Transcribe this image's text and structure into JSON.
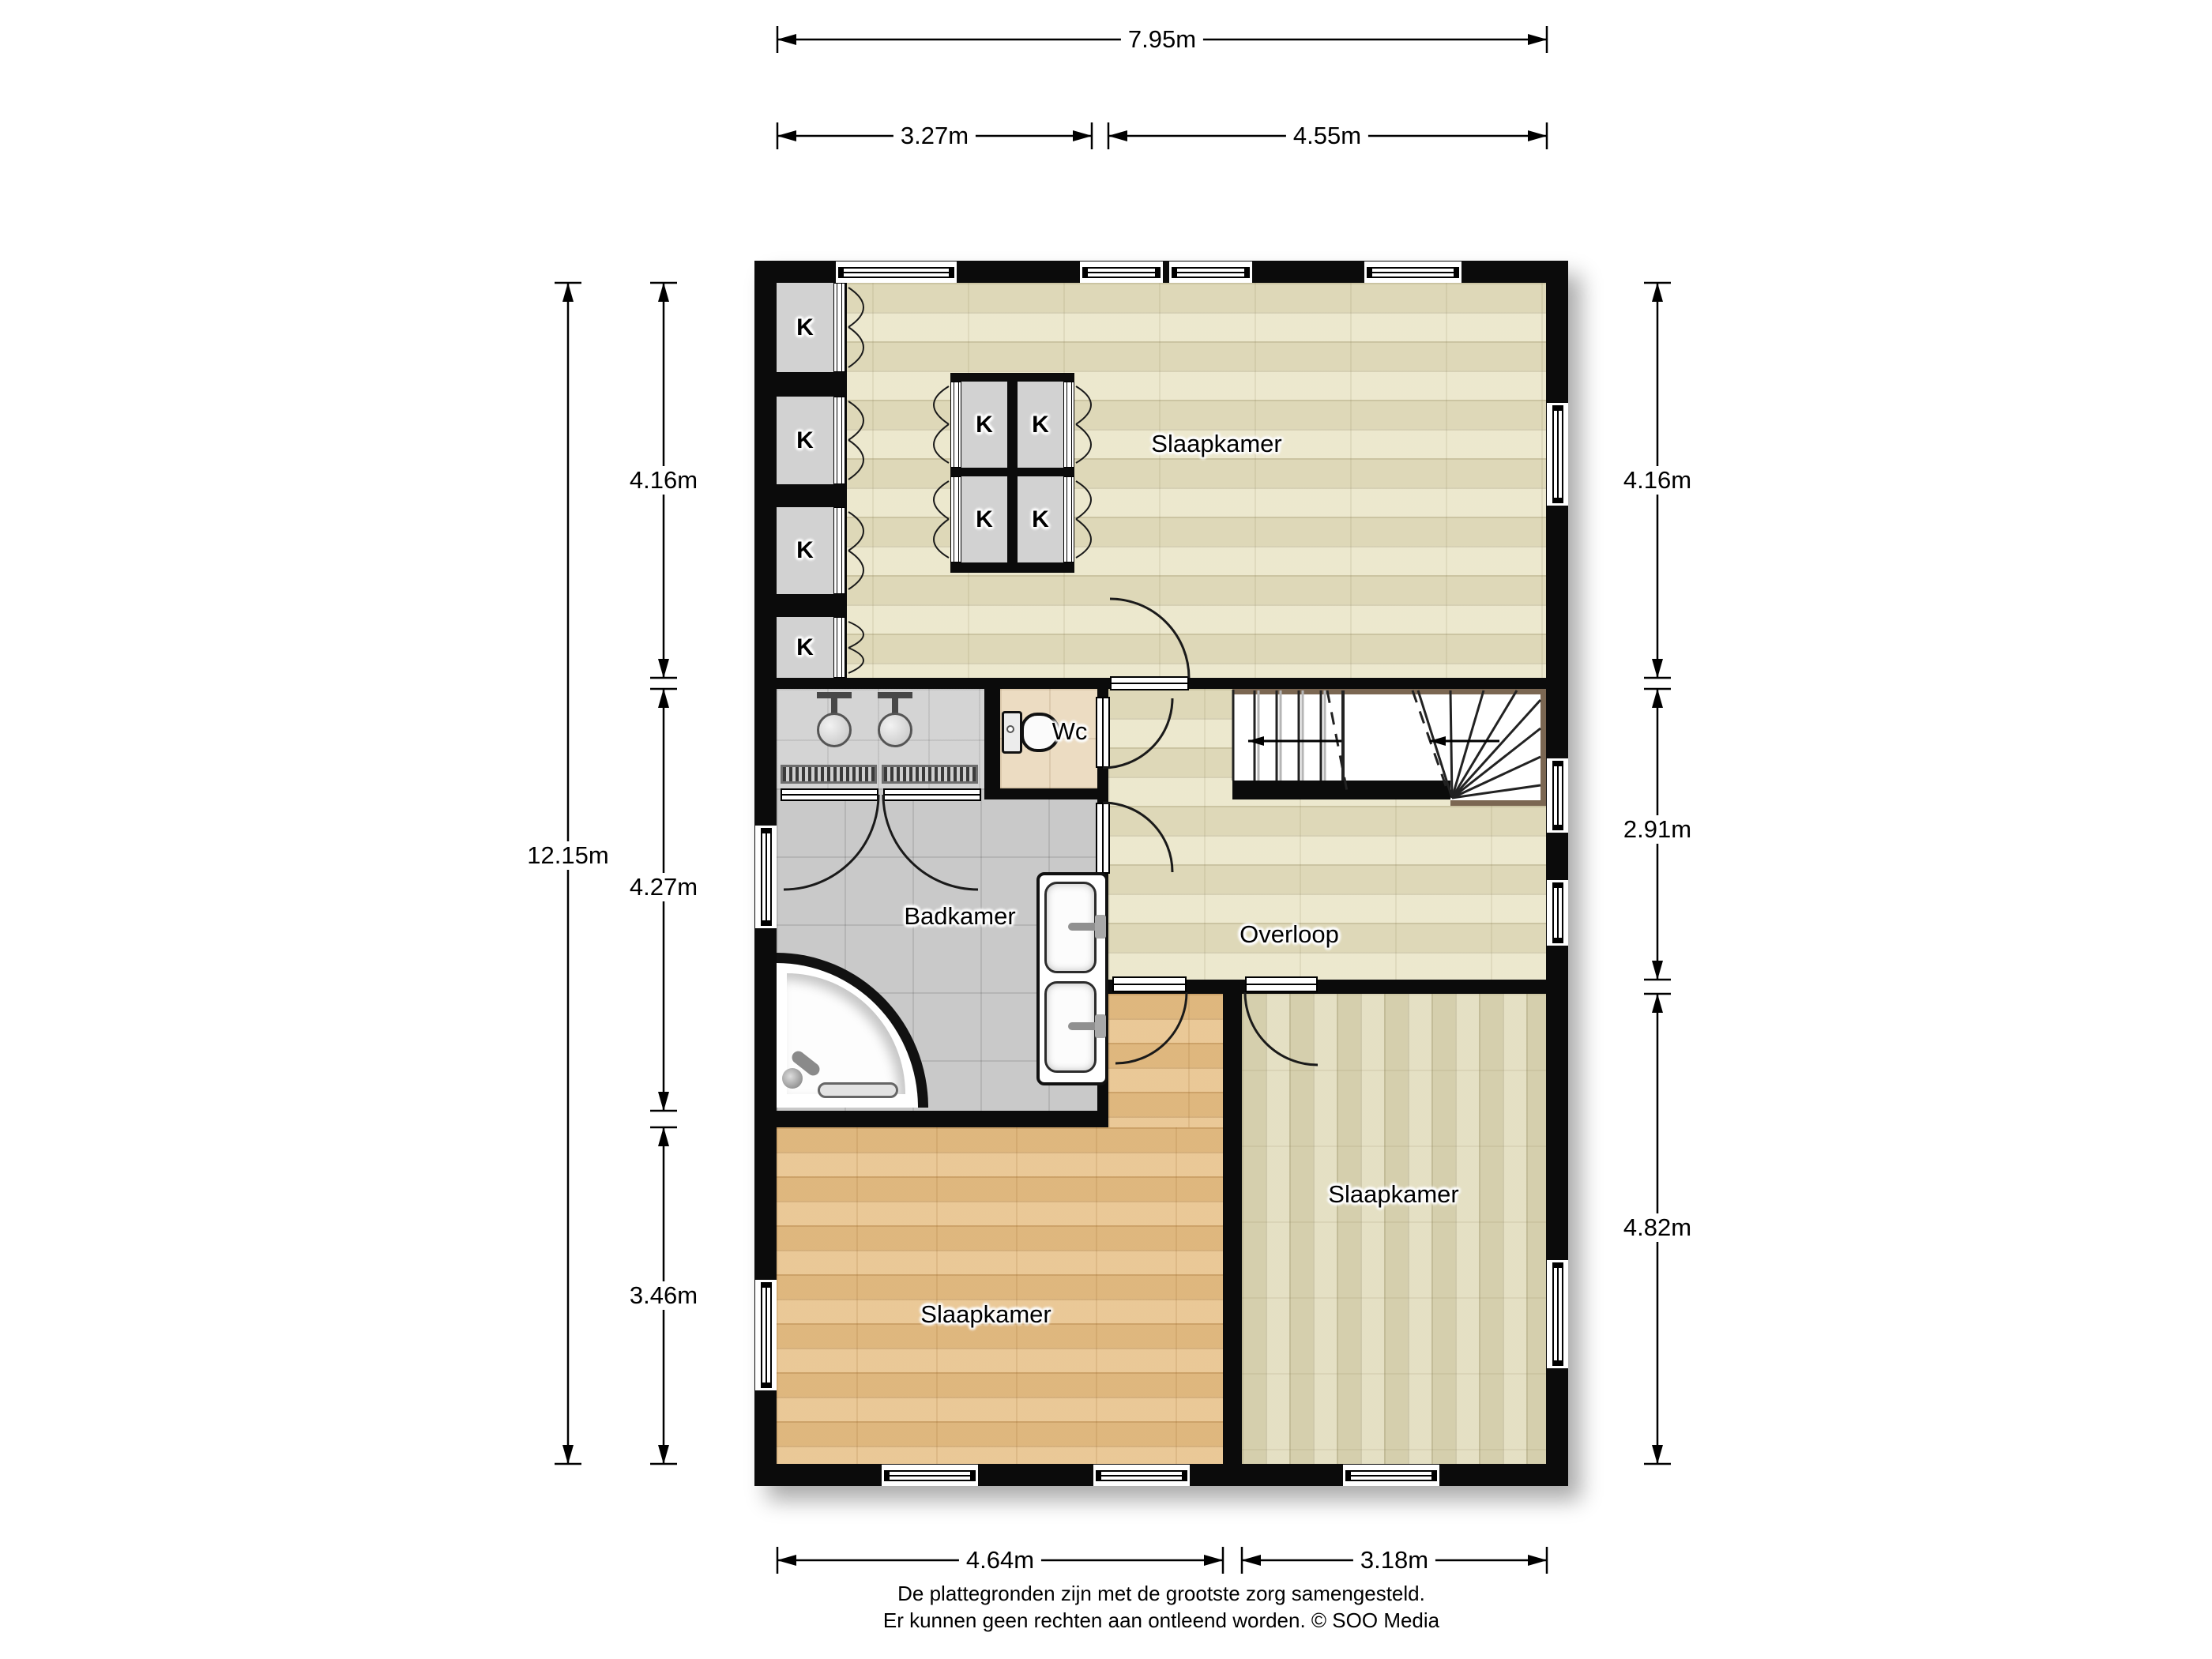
{
  "plan": {
    "rooms": {
      "slaapkamer_top": "Slaapkamer",
      "slaapkamer_left": "Slaapkamer",
      "slaapkamer_right": "Slaapkamer",
      "badkamer": "Badkamer",
      "overloop": "Overloop",
      "wc": "Wc"
    },
    "closet": {
      "label": "K"
    },
    "dims": {
      "top_total": "7.95m",
      "top_a": "3.27m",
      "top_b": "4.55m",
      "left_total": "12.15m",
      "left_a": "4.16m",
      "left_b": "4.27m",
      "left_c": "3.46m",
      "right_a": "4.16m",
      "right_b": "2.91m",
      "right_c": "4.82m",
      "bottom_a": "4.64m",
      "bottom_b": "3.18m"
    },
    "footer": {
      "line1": "De plattegronden zijn met de grootste zorg samengesteld.",
      "line2": "Er kunnen geen rechten aan ontleend worden. © SOO Media"
    },
    "colors": {
      "wall": "#0b0b0b",
      "parquet_light": "#e9e4c8",
      "parquet_vertical": "#e0dbbd",
      "parquet_tan": "#e5c08b",
      "tile_bath": "#c9c9c9",
      "tile_wc": "#ecdcc2",
      "stair_trim": "#7b6752"
    }
  }
}
